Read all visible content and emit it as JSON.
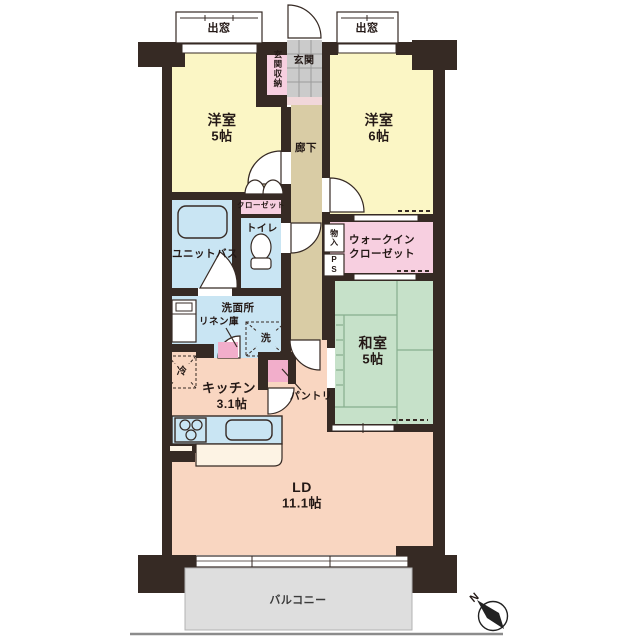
{
  "title": "マンション間取り図",
  "labels": {
    "bay_window_left": "出窓",
    "bay_window_right": "出窓",
    "entrance_storage": "玄関収納",
    "entrance": "玄関",
    "hallway": "廊下",
    "western_room_5": {
      "name": "洋室",
      "size": "5帖"
    },
    "western_room_6": {
      "name": "洋室",
      "size": "6帖"
    },
    "closet": "クローゼット",
    "unit_bath": "ユニットバス",
    "toilet": "トイレ",
    "storage_niche": "物入",
    "pipe_space": "PS",
    "walk_in_closet": {
      "line1": "ウォークイン",
      "line2": "クローゼット"
    },
    "washroom": "洗面所",
    "linen_cabinet": "リネン庫",
    "washer": "洗",
    "fridge": "冷",
    "japanese_room": {
      "name": "和室",
      "size": "5帖"
    },
    "kitchen": {
      "name": "キッチン",
      "size": "3.1帖"
    },
    "pantry": "パントリ",
    "living_dining": {
      "name": "LD",
      "size": "11.1帖"
    },
    "balcony": "バルコニー",
    "compass_north": "N"
  },
  "colors": {
    "wall": "#362a24",
    "western_room": "#fbf6c5",
    "hallway": "#d9cca5",
    "entrance_tile": "#cbcbcb",
    "entrance_step": "#f1d7da",
    "wet_area_blue": "#c9e5f3",
    "closet_pink": "#f7cfe0",
    "accent_pink": "#f2aecb",
    "tatami_green": "#c6e1c9",
    "living_salmon": "#f9d6c1",
    "counter_cream": "#fdf3e4",
    "balcony_gray": "#dedede",
    "text": "#231815"
  }
}
